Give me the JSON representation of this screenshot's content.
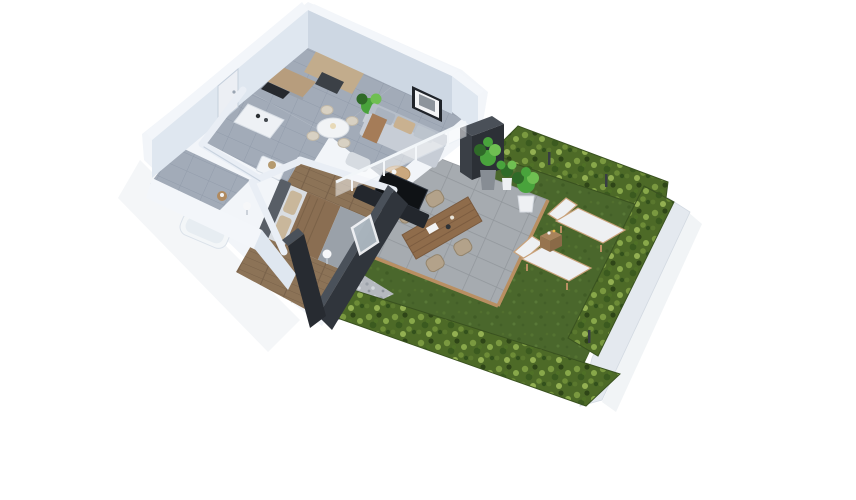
{
  "scene": {
    "description": "Isometric 3D architectural render of a one-bedroom apartment with terrace and hedged garden",
    "areas": [
      "kitchen",
      "living-room",
      "hallway",
      "bathroom",
      "bedroom",
      "terrace",
      "lawn-garden"
    ],
    "objects": [
      "entry-door",
      "kitchen-cabinets",
      "kitchen-island",
      "round-dining-table",
      "dining-chairs",
      "potted-plant",
      "sofa",
      "wall-picture",
      "coffee-table",
      "ottoman",
      "tv-sideboard",
      "double-bed",
      "headboard",
      "bedside-lamps",
      "bathtub",
      "privacy-glass-railing",
      "charcoal-privacy-wall",
      "bedroom-window",
      "outdoor-cabinet",
      "terrace-pavers",
      "wood-edging",
      "gravel-strip",
      "outdoor-dining-table",
      "wicker-chairs",
      "sun-lounger",
      "lounger-side-table",
      "garden-pot",
      "hedge",
      "lawn",
      "garden-boundary-wall",
      "fence-posts"
    ]
  },
  "colors": {
    "background": "#ffffff",
    "skirt": "#f2f5f9",
    "shadow": "#e9edf2",
    "wallTop": "#f3f6fa",
    "wallFace": "#dfe7f0",
    "wallFaceShaded": "#cdd7e3",
    "wallStrip": "#e9eef5",
    "doorFace": "#eceff4",
    "charcoalTop": "#4a515a",
    "charcoalFace": "#30353c",
    "charcoalDark": "#272b31",
    "pillarTop": "#4a5058",
    "pillarRight": "#2c3036",
    "pillarLeft": "#3a3f46",
    "tileBase": "#a2abb8",
    "tileLine": "#929cab",
    "woodFloor": "#8c7357",
    "woodFloorLine": "#79624a",
    "paverBase": "#a6abb0",
    "paverLine": "#91969b",
    "gravelBase": "#b5b9bf",
    "grassBase": "#4a672c",
    "hedgeBase": "#4d6a27",
    "hedgeOutline": "#3a5220",
    "gardenWall": "#e4e9ef",
    "woodEdge": "#b98f62",
    "woodTable": "#8f6c4b",
    "wicker": "#b3a28a",
    "loungerFabric": "#eef0f2",
    "loungerFrame": "#b98f62",
    "cubeTop": "#a8835c",
    "cubeRight": "#8a6a47",
    "cubeLeft": "#97744f",
    "sofaBody": "#c7cdd6",
    "sofaBack": "#b6bec9",
    "cushionGray": "#aab3bf",
    "cushionTan": "#c9b190",
    "throwBrown": "#a57c58",
    "mattress": "#d9dde2",
    "blanketBrown": "#8a6e52",
    "blanketGray": "#9aa1a9",
    "pillowTan": "#c9b79b",
    "headboard": "#585e66",
    "cabinetWood": "#b79d7d",
    "cabinetWoodTall": "#c2ac8c",
    "applianceDark": "#3b4046",
    "cooktop": "#26292e",
    "islandWhite": "#eef1f5",
    "tableWhite": "#f1f3f5",
    "chairBeige": "#d8d1c3",
    "coffeeWood": "#caa87e",
    "tvDark": "#23272d",
    "frameDark": "#20242a",
    "photoGray": "#8d949c",
    "glass": "#aeb9c2",
    "plantDark": "#2f6a28",
    "plantMid": "#49a33c",
    "plantLight": "#6fbf52",
    "potGray": "#878d94",
    "potWhite": "#eef0f3",
    "tubWhite": "#f3f6f8",
    "lampWhite": "#f6f7f9",
    "postDark": "#383d43"
  }
}
